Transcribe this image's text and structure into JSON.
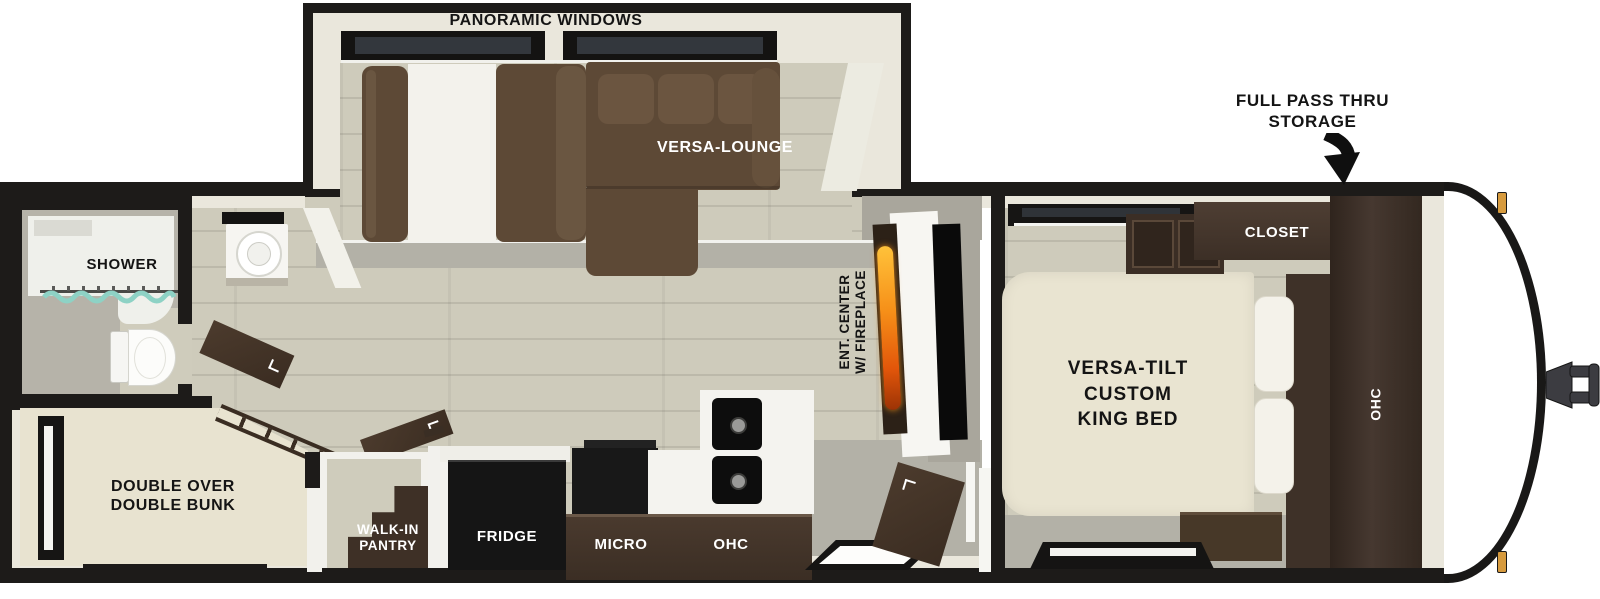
{
  "title": "RV travel trailer floor plan",
  "labels": {
    "panoramic": "PANORAMIC WINDOWS",
    "pass_thru_line1": "FULL PASS THRU",
    "pass_thru_line2": "STORAGE",
    "versa_lounge": "VERSA-LOUNGE",
    "closet": "CLOSET",
    "bed_line1": "VERSA-TILT",
    "bed_line2": "CUSTOM",
    "bed_line3": "KING BED",
    "bedroom_ohc": "OHC",
    "ent_line1": "ENT. CENTER",
    "ent_line2": "W/ FIREPLACE",
    "shower": "SHOWER",
    "bunk_line1": "DOUBLE OVER",
    "bunk_line2": "DOUBLE BUNK",
    "pantry_line1": "WALK-IN",
    "pantry_line2": "PANTRY",
    "fridge": "FRIDGE",
    "micro": "MICRO",
    "kitchen_ohc": "OHC"
  },
  "fixtures": [
    "panoramic-windows",
    "versa-lounge-sectional",
    "facing-sofa-with-table",
    "entertainment-center-with-fireplace",
    "tv-panel",
    "entry-door",
    "entry-step",
    "king-bed",
    "pillows",
    "overhead-cabinets",
    "closet",
    "wardrobe",
    "bedroom-windows",
    "shower",
    "shower-curtain",
    "toilet",
    "vanity-sink",
    "bathroom-door",
    "double-over-double-bunk",
    "bunk-ladder",
    "bunk-window",
    "walk-in-pantry-shelves",
    "refrigerator",
    "microwave",
    "double-sink",
    "front-cap",
    "hitch-coupler",
    "marker-lights",
    "pass-thru-storage-arrow"
  ],
  "colors": {
    "wall_black": "#1d1b19",
    "interior_trim": "#eae7dc",
    "wall_gray": "#a9a69c",
    "floor_wood": "#cecbbb",
    "floor_gray": "#b3b1a7",
    "sofa_brown": "#5d4936",
    "cabinet_brown": "#3f3229",
    "mattress_cream": "#e8e3d0",
    "counter_white": "#f4f3ef",
    "appliance_black": "#121212",
    "flame_orange": "#f68f18",
    "curtain_teal": "#8ed2c5",
    "marker_amber": "#d79b3e"
  }
}
